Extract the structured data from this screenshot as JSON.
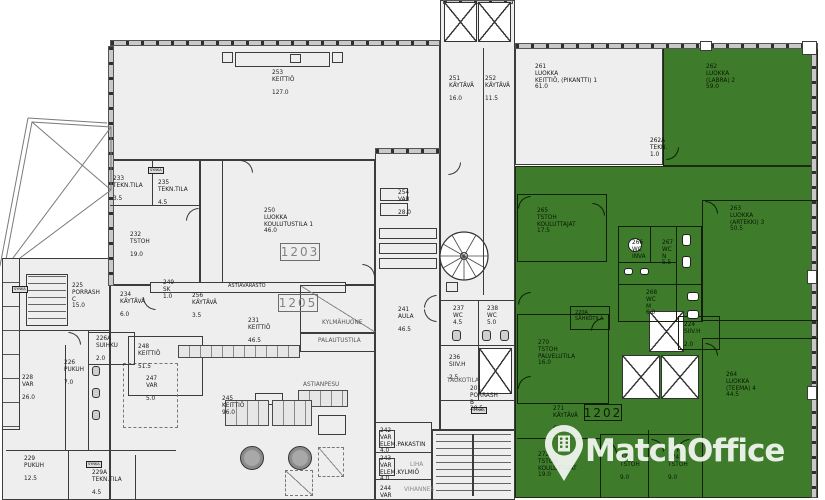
{
  "watermark": {
    "brand": "MatchOffice"
  },
  "chip": {
    "label": "SYNKA"
  },
  "units": {
    "b1203": "1203",
    "b1205": "1205",
    "b1202": "1202"
  },
  "colors": {
    "highlight_green": "#3e7c2c",
    "floor": "#efeeee",
    "wall": "#3c3c3c",
    "watermark": "#ffffff"
  },
  "areas": {
    "astiavarasto": "ASTIAVARASTO",
    "kylmahuone": "KYLMÄHUONE",
    "palautustila": "PALAUTUSTILA",
    "astianpesu": "ASTIANPESU",
    "taukotila": "TAUKOTILA",
    "liha": "LIHA",
    "vihannes": "VIHANNES"
  },
  "rooms": {
    "r253": "253\nKEITTIÖ\n\n127.0",
    "r251": "251\nKÄYTÄVÄ\n\n16.0",
    "r252": "252\nKÄYTÄVÄ\n\n11.5",
    "r261": "261\nLUOKKA\nKEITTIÖ, (PIKANTTI) 1\n61.0",
    "r262": "262\nLUOKKA\n(LABRA) 2\n59.0",
    "r262a": "262A\nTEKN.\n1.0",
    "r263": "263\nLUOKKA\n(ARTEKKI) 3\n50.5",
    "r264": "264\nLUOKKA\n(TEEMA) 4\n44.5",
    "r265": "265\nTSTOH\nKOULUTTAJAT\n17.5",
    "r266": "266\nWC\nINVA",
    "r267": "267\nWC\nN\n5.5",
    "r268": "268\nWC\nM\n6.0",
    "r270": "270\nTSTOH\nPALVELUTILA\n16.0",
    "r271": "271\nKÄYTÄVÄ\n\n68.5",
    "r272": "272\nTSTOH\nKOULUTTAJAT\n19.0",
    "r273": "273\nTSTOH\n\n9.0",
    "r274": "274\nTSTOH\n\n9.0",
    "r220a": "220A\nSÄHKÖTILA",
    "r224": "224\nSIIV.H\n\n2.0",
    "r225": "225\nPORRASH\nC\n15.0",
    "r226": "226\nPUKUH\n\n7.0",
    "r226a": "226A\nSUIHKU\n\n2.0",
    "r228": "228\nVAR\n\n26.0",
    "r229": "229\nPUKUH\n\n12.5",
    "r229a": "229A\nTEKN.TILA\n\n4.5",
    "r231": "231\nKEITTIÖ\n\n46.5",
    "r232": "232\nTSTOH\n\n19.0",
    "r233": "233\nTEKN.TILA\n\n3.5",
    "r234": "234\nKÄYTÄVÄ\n\n6.0",
    "r235": "235\nTEKN.TILA\n\n4.5",
    "r236": "236\nSIIV.H\n\n2.5",
    "r237": "237\nWC\n4.5",
    "r238": "238\nWC\n5.0",
    "r241": "241\nAULA\n\n46.5",
    "r242": "242\nVAR\nELEM.PAKASTIN\n4.0",
    "r243": "243\nVAR\nELEM.KYLMIÖ\n4.0",
    "r244": "244\nVAR",
    "r245": "245\nKEITTIÖ\n96.0",
    "r247": "247\nVAR\n\n5.0",
    "r248": "248\nKEITTIÖ\n\n51.5",
    "r249": "249\nSK\n1.0",
    "r250": "250\nLUOKKA\nKOULUTUSTILA 1\n46.0",
    "r254": "254\nVAR\n\n28.0",
    "r256": "256\nKÄYTÄVÄ\n\n3.5",
    "r201": "201\nPORRASH\nB\n20.5"
  }
}
